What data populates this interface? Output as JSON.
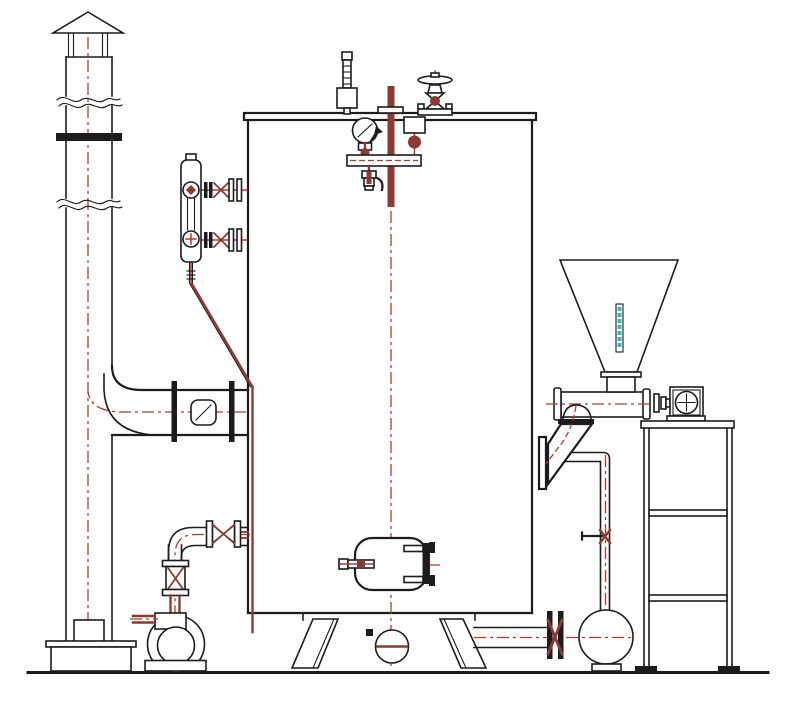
{
  "drawing": {
    "kind": "vertical-boiler-installation-schematic",
    "has_visible_text": false,
    "components": [
      {
        "name": "chimney-stack",
        "parts": [
          "rain-cap",
          "cap-posts",
          "break-lines",
          "stack-flange",
          "cleanout-door",
          "pedestal"
        ]
      },
      {
        "name": "flue-duct",
        "parts": [
          "duct-flanges",
          "damper",
          "elbow-to-chimney"
        ]
      },
      {
        "name": "boiler-vessel",
        "parts": [
          "top-plate",
          "shell",
          "support-legs",
          "bottom-drain",
          "manhole"
        ]
      },
      {
        "name": "water-level-gauge",
        "parts": [
          "sight-glass",
          "upper-valve",
          "lower-valve",
          "shell-flanges",
          "drain-cock",
          "blowdown-line"
        ]
      },
      {
        "name": "safety-valve"
      },
      {
        "name": "level-probe-pipe"
      },
      {
        "name": "main-steam-valve",
        "parts": [
          "handwheel",
          "globe-body"
        ]
      },
      {
        "name": "pressure-gauge-assembly",
        "parts": [
          "gauge-dial",
          "gauge-cock",
          "siphon-manifold",
          "drain-valve",
          "shutoff-valve"
        ]
      },
      {
        "name": "feed-water-line",
        "parts": [
          "feed-pump",
          "suction-stub",
          "discharge-valve",
          "check-valve"
        ]
      },
      {
        "name": "fuel-hopper",
        "parts": [
          "level-strip"
        ]
      },
      {
        "name": "screw-feeder",
        "parts": [
          "end-flanges",
          "coupling",
          "drive-motor"
        ]
      },
      {
        "name": "feed-chute"
      },
      {
        "name": "blowdown-circuit",
        "parts": [
          "down-pipe",
          "hand-valve",
          "blowdown-pump",
          "bottom-valve"
        ]
      },
      {
        "name": "equipment-stand",
        "parts": [
          "top-plate",
          "legs",
          "rails",
          "feet"
        ]
      },
      {
        "name": "ground-line"
      }
    ]
  },
  "colors": {
    "paper": "#fefefe",
    "ink": "#1c1c1c",
    "red": "#b23a30",
    "dred": "#8d3a35",
    "teal": "#35b8b8"
  }
}
